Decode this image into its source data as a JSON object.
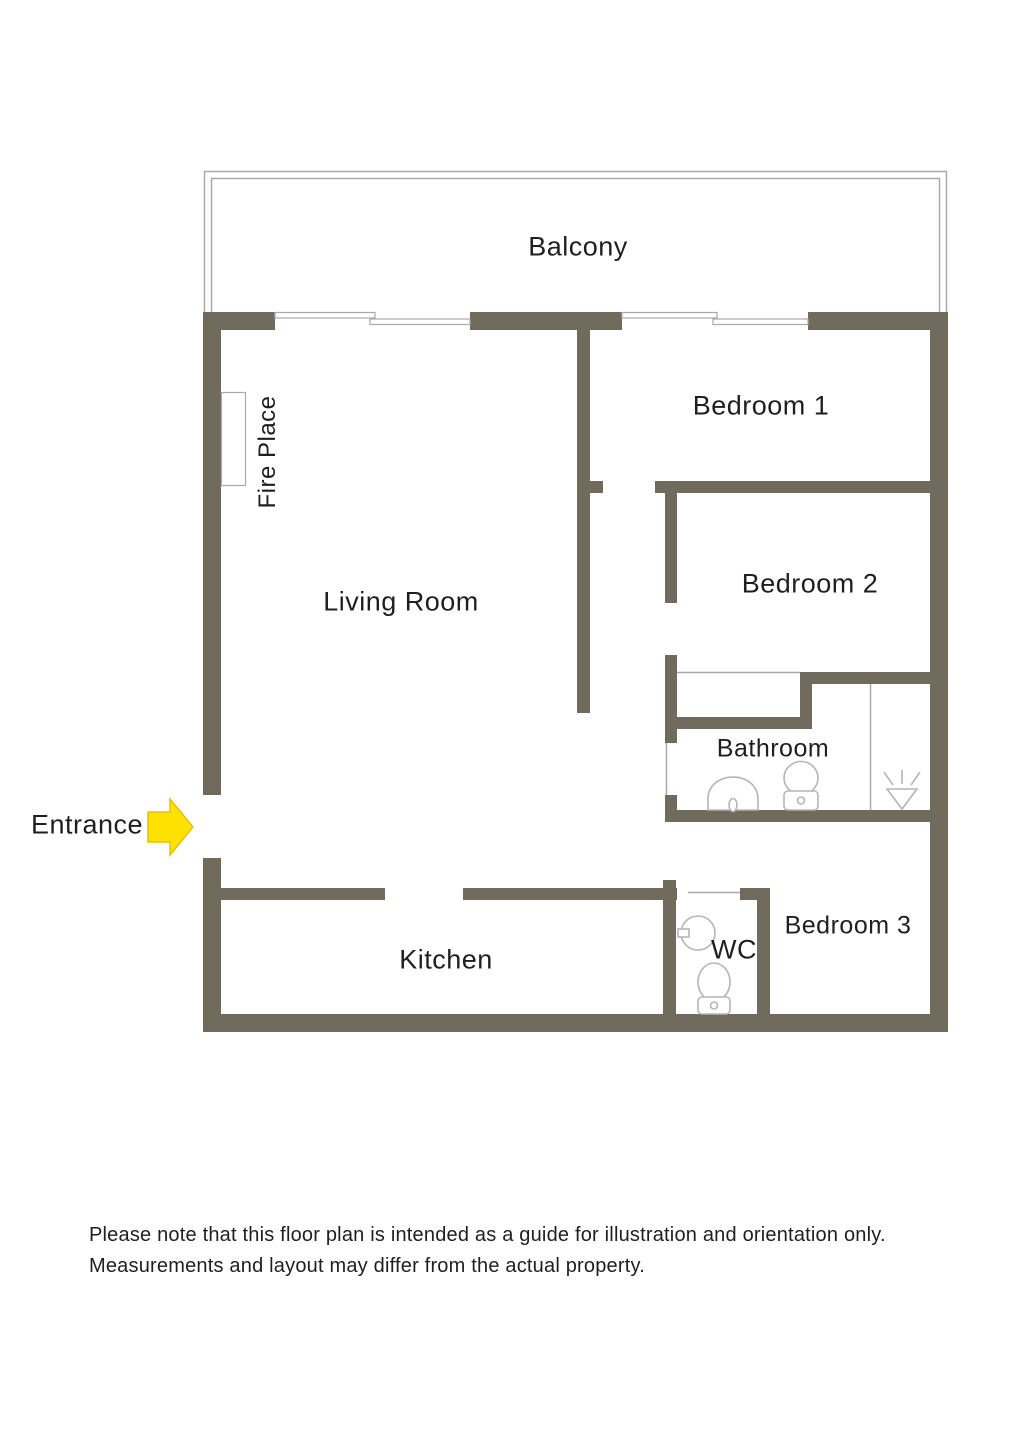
{
  "page": {
    "type": "floor-plan",
    "background": "#ffffff"
  },
  "colors": {
    "background": "#ffffff",
    "wall": "#716b5e",
    "line": "#a9a9a9",
    "fixture": "#b5b5b5",
    "text": "#1f1f1f",
    "arrow": "#ffe100",
    "arrow_border": "#e3c300"
  },
  "rooms": {
    "balcony": "Balcony",
    "bedroom1": "Bedroom 1",
    "bedroom2": "Bedroom 2",
    "bathroom": "Bathroom",
    "bedroom3": "Bedroom 3",
    "living_room": "Living Room",
    "kitchen": "Kitchen",
    "wc": "WC",
    "fireplace": "Fire Place"
  },
  "entrance": {
    "label": "Entrance",
    "icon": "entrance-arrow-icon",
    "direction": "right"
  },
  "fixtures": [
    "fireplace-icon",
    "window-icon",
    "window-icon",
    "bathroom-sink-icon",
    "bathroom-toilet-icon",
    "shower-icon",
    "wc-sink-icon",
    "wc-toilet-icon"
  ],
  "disclaimer": {
    "line1": "Please note that this floor plan is intended as a guide for illustration and orientation only.",
    "line2": "Measurements and layout may differ from the actual property."
  }
}
